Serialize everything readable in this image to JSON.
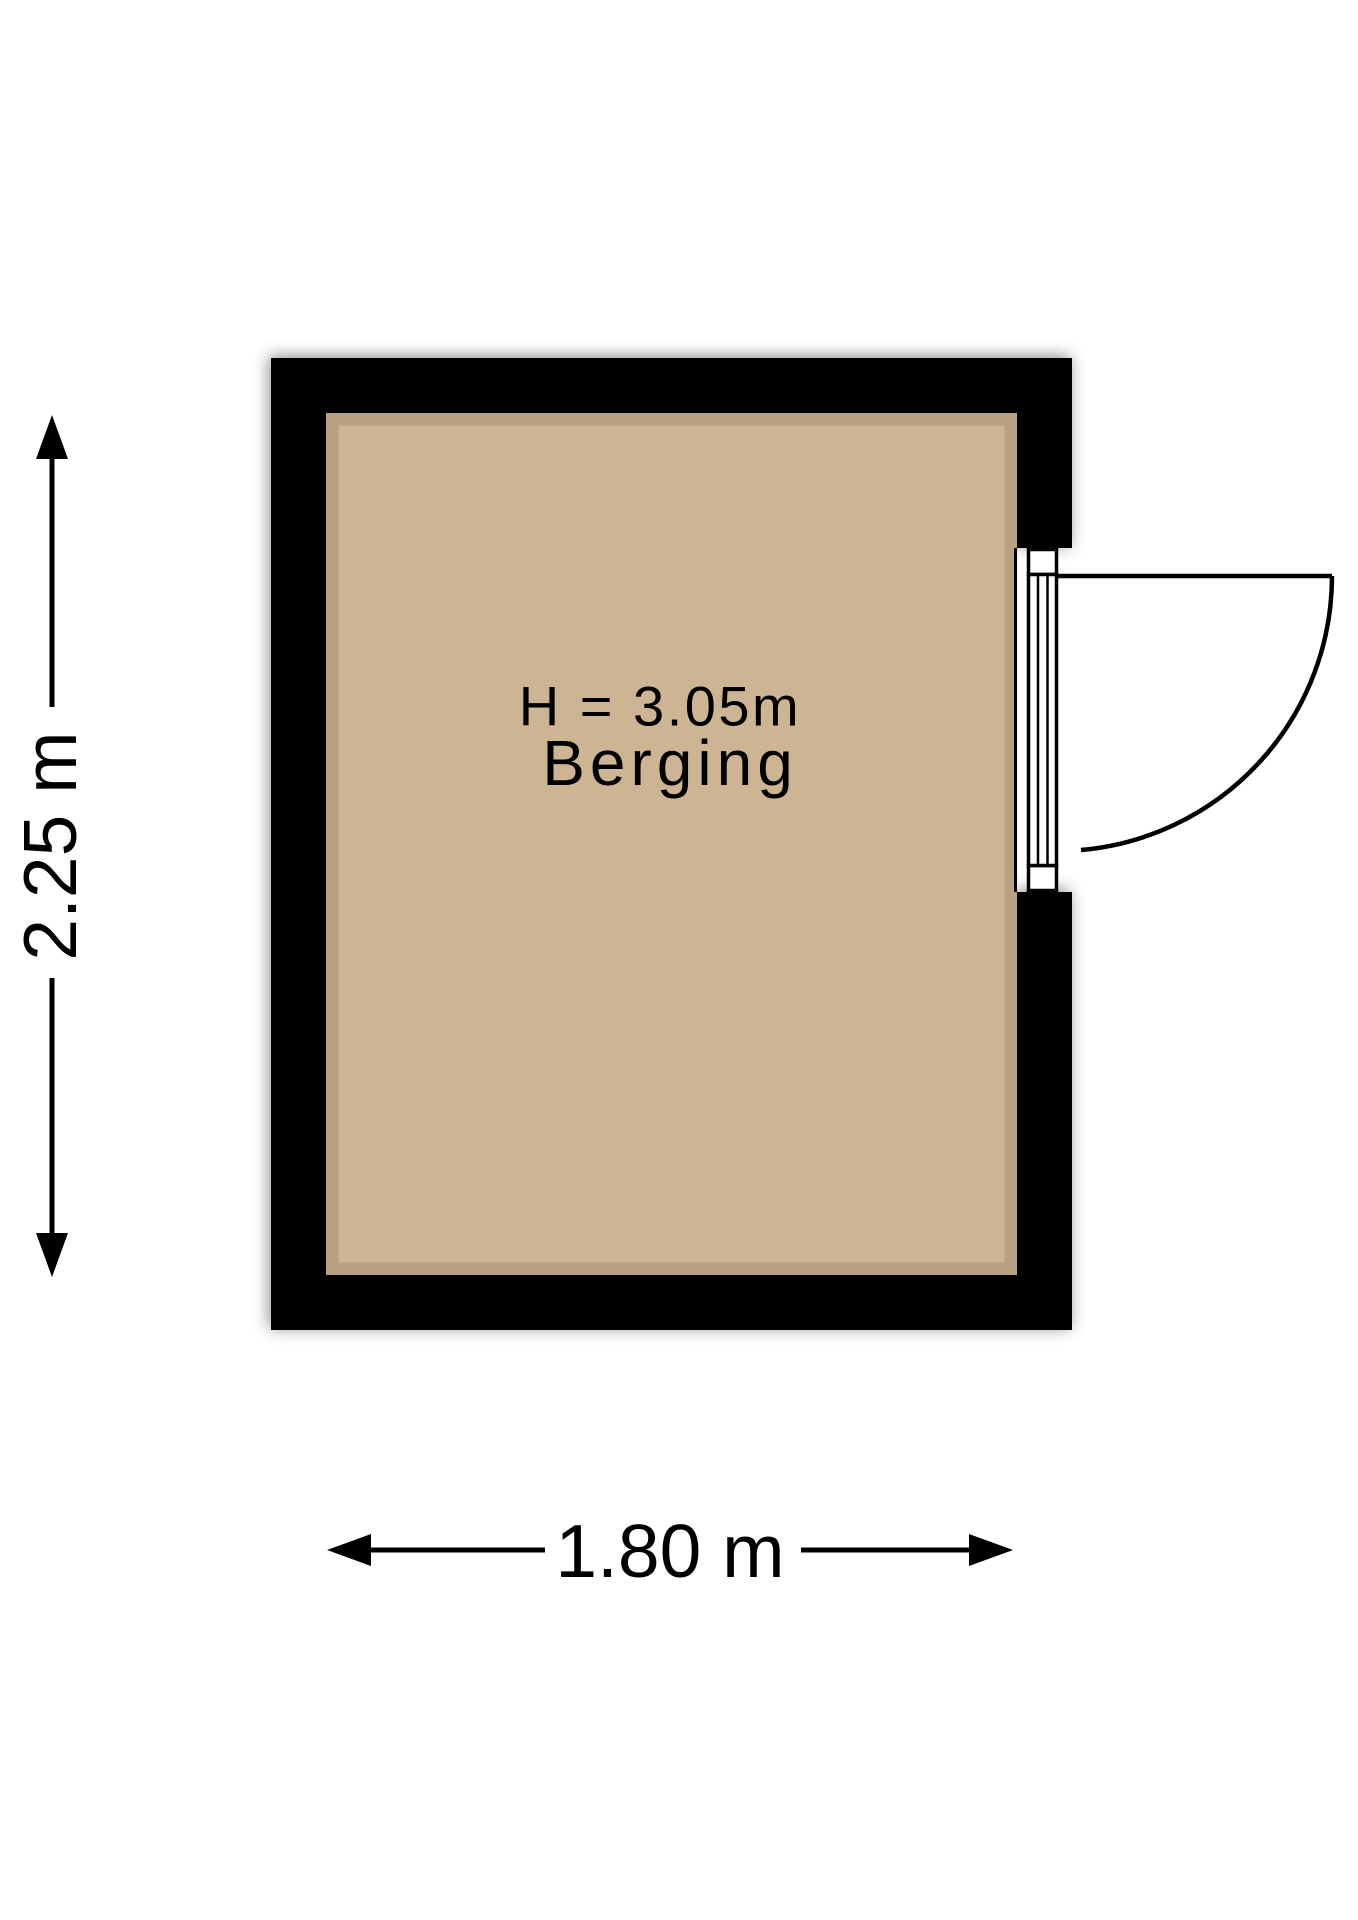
{
  "colors": {
    "background": "#ffffff",
    "wall": "#000000",
    "floor": "#cdb492",
    "floor-edge": "rgba(0,0,0,0.10)",
    "line": "#000000",
    "text": "#000000"
  },
  "floorplan": {
    "room": {
      "name": "Berging",
      "ceiling_height_label": "H = 3.05m",
      "width_label": "1.80 m",
      "depth_label": "2.25 m"
    },
    "door": {
      "wall": "right",
      "type": "hinged",
      "swing": "outward"
    }
  }
}
